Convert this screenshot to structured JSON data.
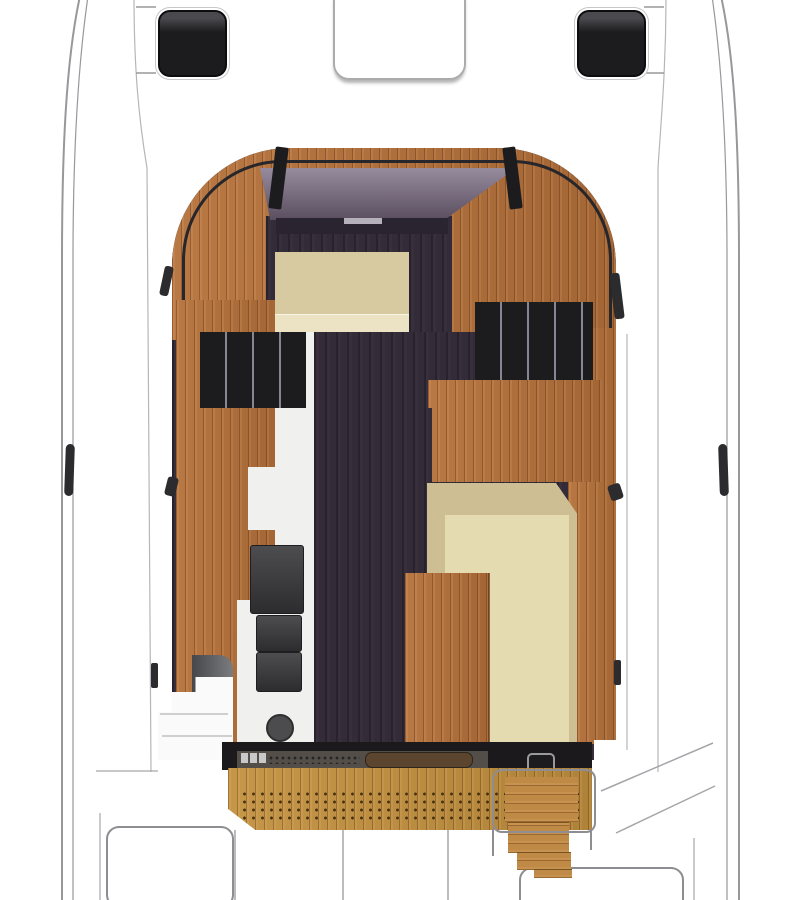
{
  "image": {
    "type": "motor-yacht deck floor plan, top-down view",
    "width": 800,
    "height": 900,
    "visible_text": "none"
  },
  "colors": {
    "deck_white": "#ffffff",
    "hull_line": "#98989c",
    "deck_line": "#b6b6ba",
    "divider_line": "#a6a6aa",
    "hatch_black": "#1c1c1e",
    "hatch_outline": "#ababae",
    "frame_black": "#26262b",
    "teak": "#b5713a",
    "teak_step": "#bf8a45",
    "cabin_floor": "#332b38",
    "windshield": "#83768a",
    "dash_dark": "#2a2430",
    "dash_light": "#b5b0ba",
    "berth": "#d8caa0",
    "berth_light": "#ebe3c3",
    "settee": "#cdbf93",
    "settee_light": "#e5dbb1",
    "counter_white": "#f0f0ee",
    "appliance": "#39393c",
    "appliance_dark": "#4c4c4f",
    "locker_gray": "#55575b",
    "steps_white": "#fafafa",
    "step_line": "#cfcfd2",
    "strip_black": "#1b191c",
    "strip_panel": "#534e48",
    "strip_dash": "#c9c9c9",
    "rod_brown": "#5b452e",
    "mat": "#c2913f",
    "mat_dot": "#4a3211",
    "rail_gray": "#8e8e92",
    "stanchion": "#2c2c2f"
  },
  "areas": {
    "foredeck": {
      "parts": [
        "port-deck-hatch",
        "center-deck-hatch-outline",
        "starboard-deck-hatch",
        "deck-tick-marks"
      ]
    },
    "side_decks": {
      "parts": [
        "port-hull-lines",
        "starboard-hull-lines",
        "port-cleat",
        "starboard-cleat",
        "stanchion-marks"
      ]
    },
    "cabin": {
      "parts": [
        "cabin-arch-roof",
        "windshield-glass",
        "windshield-struts",
        "v-berth",
        "port-louvered-lockers",
        "starboard-louvered-lockers",
        "galley-counter",
        "stove",
        "sink",
        "wet-locker",
        "dinette-seat",
        "dinette-table",
        "teak-cabin-sole"
      ]
    },
    "cockpit": {
      "parts": [
        "sliding-door-track",
        "door-handle",
        "grab-rod",
        "perforated-teak-mat",
        "companionway-steps",
        "step-handrail",
        "cockpit-seat-panels",
        "transom-lines"
      ]
    }
  }
}
